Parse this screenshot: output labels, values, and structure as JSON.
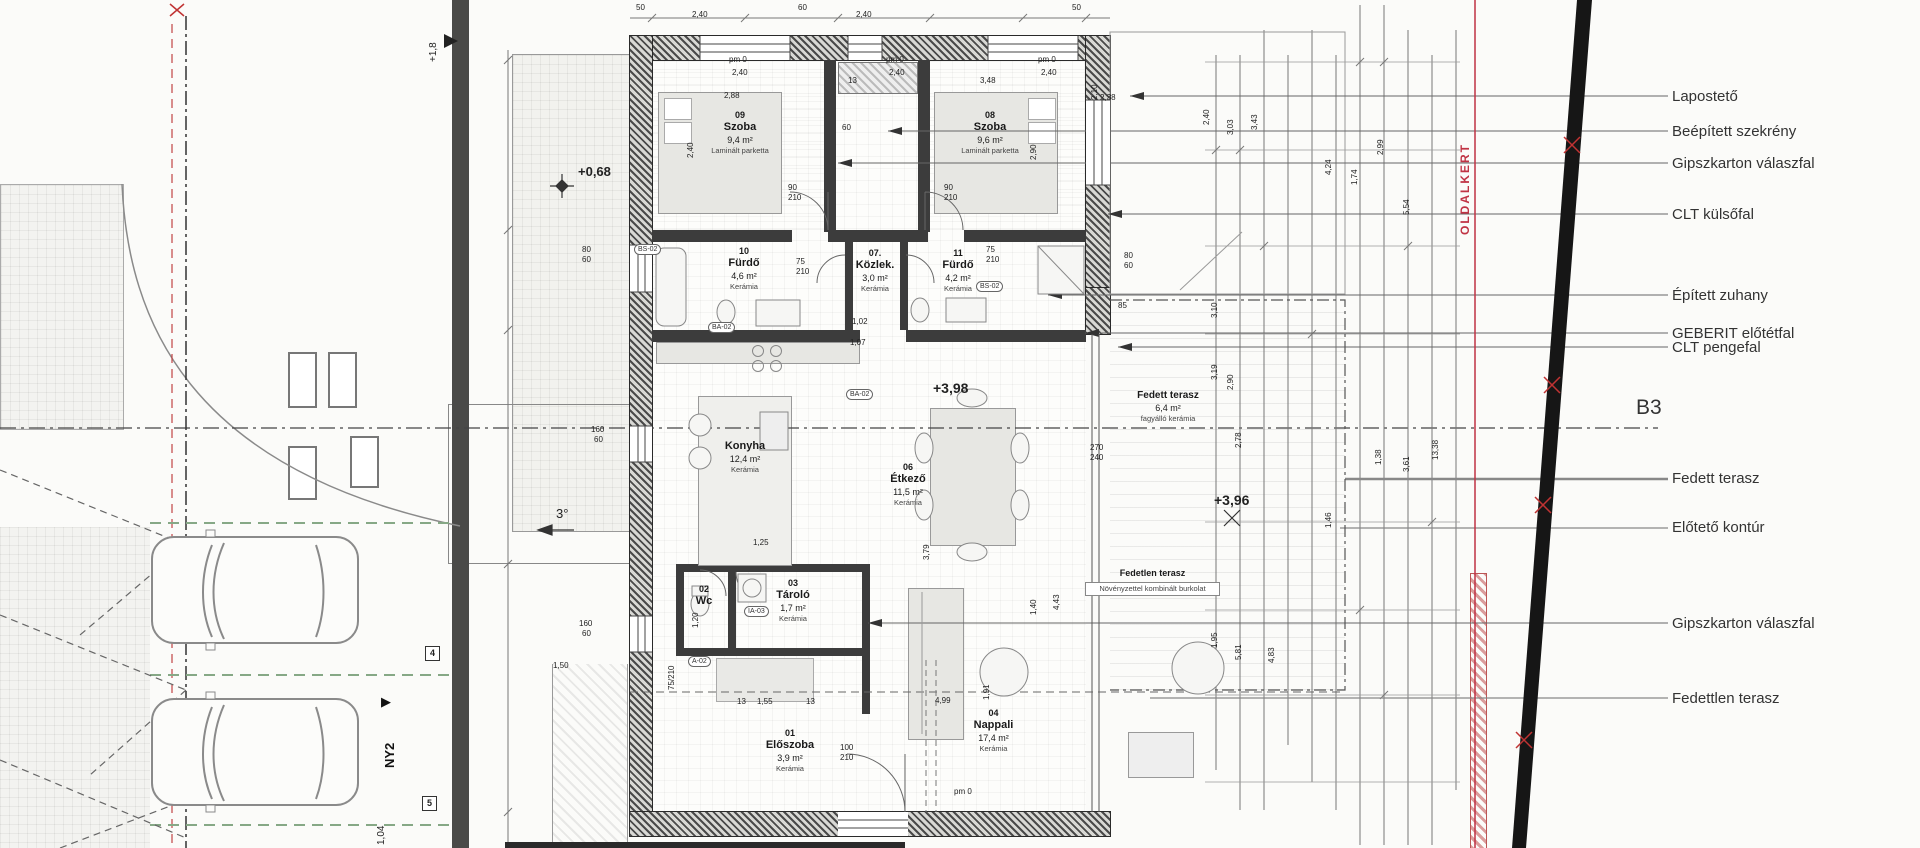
{
  "site": {
    "plus_1_8": "+1,8",
    "fence_len": "1,04",
    "ny2": "NY2",
    "ny2_arrow": "▶",
    "marker_4": "4",
    "marker_5": "5",
    "slope": "3°",
    "oldalkert": "OLDALKERT",
    "b3": "B3"
  },
  "levels": {
    "garden": "+0,68",
    "floor": "+3,98",
    "terrace": "+3,96"
  },
  "rooms": [
    {
      "number": "01",
      "name": "Előszoba",
      "area": "3,9 m²",
      "floor": "Kerámia"
    },
    {
      "number": "02",
      "name": "Wc",
      "area": "",
      "floor": ""
    },
    {
      "number": "03",
      "name": "Tároló",
      "area": "1,7 m²",
      "floor": "Kerámia"
    },
    {
      "number": "04",
      "name": "Nappali",
      "area": "17,4 m²",
      "floor": "Kerámia"
    },
    {
      "number": "",
      "name": "Konyha",
      "area": "12,4 m²",
      "floor": "Kerámia"
    },
    {
      "number": "06",
      "name": "Étkező",
      "area": "11,5 m²",
      "floor": "Kerámia"
    },
    {
      "number": "07.",
      "name": "Közlek.",
      "area": "3,0 m²",
      "floor": "Kerámia"
    },
    {
      "number": "08",
      "name": "Szoba",
      "area": "9,6 m²",
      "floor": "Laminált parketta"
    },
    {
      "number": "09",
      "name": "Szoba",
      "area": "9,4 m²",
      "floor": "Laminált parketta"
    },
    {
      "number": "10",
      "name": "Fürdő",
      "area": "4,6 m²",
      "floor": "Kerámia"
    },
    {
      "number": "11",
      "name": "Fürdő",
      "area": "4,2 m²",
      "floor": "Kerámia"
    },
    {
      "number": "",
      "name": "Fedett terasz",
      "area": "6,4 m²",
      "floor": "fagyálló kerámia"
    },
    {
      "number": "",
      "name": "Fedetlen terasz",
      "area": "",
      "floor": "Növényzettel kombinált burkolat"
    }
  ],
  "legend": [
    "Lapostető",
    "Beépített szekrény",
    "Gipszkarton válaszfal",
    "CLT külsőfal",
    "Épített zuhany",
    "GEBERIT előtétfal",
    "CLT pengefal",
    "Fedett terasz",
    "Előtető kontúr",
    "Gipszkarton válaszfal",
    "Fedettlen terasz"
  ],
  "dims": [
    "50",
    "2,40",
    "60",
    "2,40",
    "50",
    "2,88",
    "13",
    "3,48",
    "2,38",
    "60",
    "90",
    "210",
    "90",
    "210",
    "75",
    "210",
    "75",
    "210",
    "80",
    "60",
    "80",
    "60",
    "160",
    "60",
    "160",
    "60",
    "270",
    "240",
    "85",
    "1,02",
    "13",
    "1,55",
    "13",
    "1,25",
    "1,50",
    "4,99",
    "100",
    "210",
    "1,07",
    "1,20",
    "75/210",
    "2,40",
    "2,90",
    "2,10",
    "3,79",
    "4,43",
    "1,40",
    "1,91",
    "2,40",
    "3,03",
    "3,43",
    "2,99",
    "4,24",
    "5,54",
    "1,74",
    "13,38",
    "3,61",
    "1,38",
    "2,90",
    "3,19",
    "2,78",
    "1,46",
    "5,81",
    "4,83",
    "1,95",
    "3,10",
    "pm 0",
    "2,40",
    "pm 0",
    "2,40",
    "pm 0",
    "2,40",
    "pm 0"
  ],
  "capsules": [
    "BS-02",
    "BA-02",
    "BA-02",
    "A-02",
    "IA-03",
    "BS-02"
  ]
}
